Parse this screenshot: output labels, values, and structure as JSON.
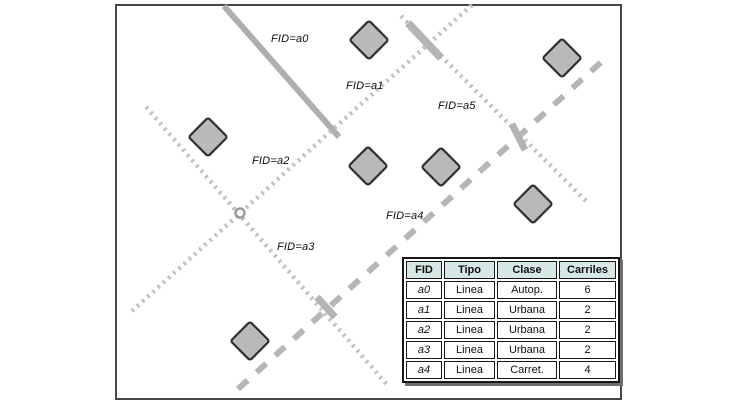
{
  "figure": {
    "width": 732,
    "height": 408,
    "background": "#ffffff",
    "frame_border_color": "#474747"
  },
  "map": {
    "frame": {
      "left": 115,
      "top": 4,
      "width": 507,
      "height": 396
    },
    "line_styles": {
      "solid": {
        "color": "#afafaf",
        "width": 6,
        "dash": ""
      },
      "dotted": {
        "color": "#c1c1c1",
        "width": 4.5,
        "dash": "2.5 4.5"
      },
      "dashed": {
        "color": "#b6b6b6",
        "width": 6,
        "dash": "13 12"
      }
    },
    "lines": [
      {
        "id": "a0",
        "kind": "solid",
        "x1": 224,
        "y1": 6,
        "x2": 339,
        "y2": 137
      },
      {
        "id": "a1",
        "kind": "dotted",
        "x1": 472,
        "y1": 5,
        "x2": 331,
        "y2": 131
      },
      {
        "id": "a2",
        "kind": "dotted",
        "x1": 331,
        "y1": 131,
        "x2": 132,
        "y2": 311
      },
      {
        "id": "a3",
        "kind": "dotted",
        "x1": 146,
        "y1": 107,
        "x2": 389,
        "y2": 387
      },
      {
        "id": "a4",
        "kind": "dashed",
        "x1": 238,
        "y1": 389,
        "x2": 608,
        "y2": 56
      },
      {
        "id": "a5",
        "kind": "dotted",
        "x1": 401,
        "y1": 16,
        "x2": 589,
        "y2": 204
      }
    ],
    "crossing_marks": [
      {
        "x1": 408,
        "y1": 23,
        "x2": 441,
        "y2": 58,
        "width": 8
      },
      {
        "x1": 512,
        "y1": 124,
        "x2": 525,
        "y2": 150,
        "width": 7
      },
      {
        "x1": 317,
        "y1": 297,
        "x2": 335,
        "y2": 317,
        "width": 7
      }
    ],
    "mark_color": "#b4b4b4",
    "vertex_ring": {
      "x": 240,
      "y": 213,
      "r": 4.5,
      "color": "#9c9c9c"
    },
    "point_style": {
      "size": 27.5,
      "fill": "#b9b9b9",
      "stroke": "#2f2f2f",
      "stroke_width": 2.2
    },
    "points": [
      {
        "x": 208,
        "y": 137
      },
      {
        "x": 369,
        "y": 40
      },
      {
        "x": 562,
        "y": 58
      },
      {
        "x": 368,
        "y": 166
      },
      {
        "x": 441,
        "y": 167
      },
      {
        "x": 533,
        "y": 204
      },
      {
        "x": 250,
        "y": 341
      }
    ],
    "labels": [
      {
        "id": "a0",
        "text": "FID=a0",
        "x": 271,
        "y": 33
      },
      {
        "id": "a1",
        "text": "FID=a1",
        "x": 346,
        "y": 80
      },
      {
        "id": "a5",
        "text": "FID=a5",
        "x": 438,
        "y": 100
      },
      {
        "id": "a2",
        "text": "FID=a2",
        "x": 252,
        "y": 155
      },
      {
        "id": "a4",
        "text": "FID=a4",
        "x": 386,
        "y": 210
      },
      {
        "id": "a3",
        "text": "FID=a3",
        "x": 277,
        "y": 241
      }
    ]
  },
  "table": {
    "header_bg": "#d6e7e6",
    "headers": [
      "FID",
      "Tipo",
      "Clase",
      "Carriles"
    ],
    "rows": [
      [
        "a0",
        "Linea",
        "Autop.",
        "6"
      ],
      [
        "a1",
        "Linea",
        "Urbana",
        "2"
      ],
      [
        "a2",
        "Linea",
        "Urbana",
        "2"
      ],
      [
        "a3",
        "Linea",
        "Urbana",
        "2"
      ],
      [
        "a4",
        "Linea",
        "Carret.",
        "4"
      ]
    ]
  }
}
